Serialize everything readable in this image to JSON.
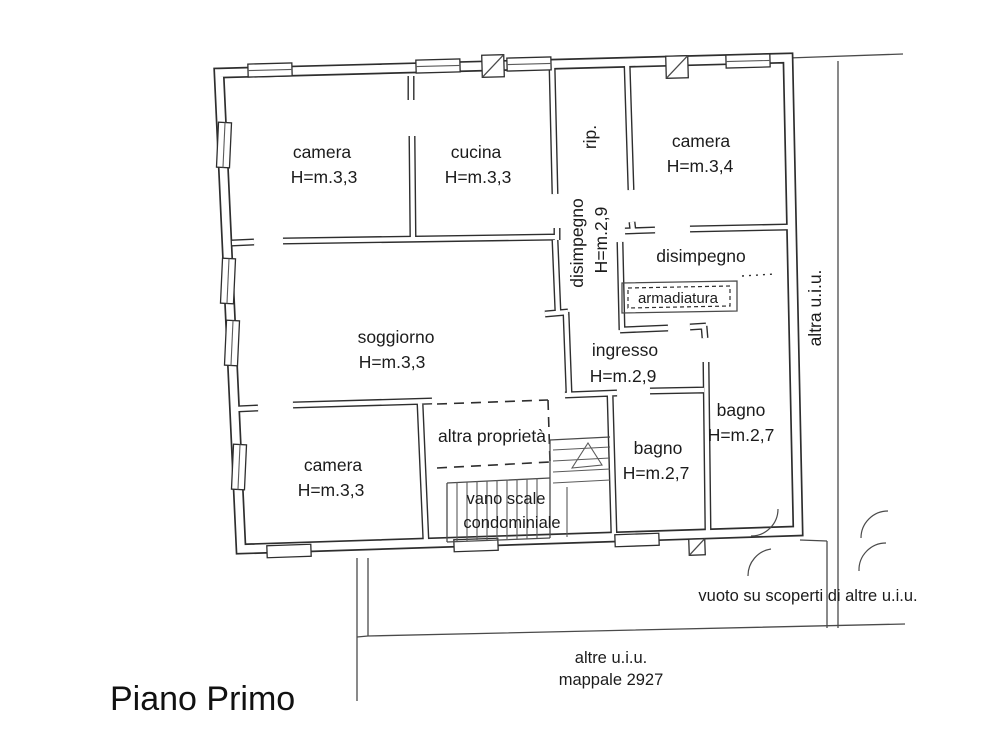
{
  "title": "Piano Primo",
  "rooms": {
    "camera_nw": {
      "name": "camera",
      "h": "H=m.3,3"
    },
    "cucina": {
      "name": "cucina",
      "h": "H=m.3,3"
    },
    "rip": {
      "name": "rip."
    },
    "disimpegno_w": {
      "name": "disimpegno",
      "h": "H=m.2,9"
    },
    "camera_ne": {
      "name": "camera",
      "h": "H=m.3,4"
    },
    "disimpegno_e": {
      "name": "disimpegno"
    },
    "armadiatura": {
      "name": "armadiatura"
    },
    "soggiorno": {
      "name": "soggiorno",
      "h": "H=m.3,3"
    },
    "ingresso": {
      "name": "ingresso",
      "h": "H=m.2,9"
    },
    "bagno_e": {
      "name": "bagno",
      "h": "H=m.2,7"
    },
    "bagno_c": {
      "name": "bagno",
      "h": "H=m.2,7"
    },
    "altra_proprieta": {
      "name": "altra proprietà"
    },
    "camera_sw": {
      "name": "camera",
      "h": "H=m.3,3"
    },
    "vano_scale": {
      "line1": "vano scale",
      "line2": "condominiale"
    },
    "altra_uiu": {
      "name": "altra u.i.u."
    }
  },
  "notes": {
    "vuoto": "vuoto su scoperti di altre u.i.u.",
    "altre_uiu": "altre u.i.u.",
    "mappale": "mappale 2927"
  }
}
